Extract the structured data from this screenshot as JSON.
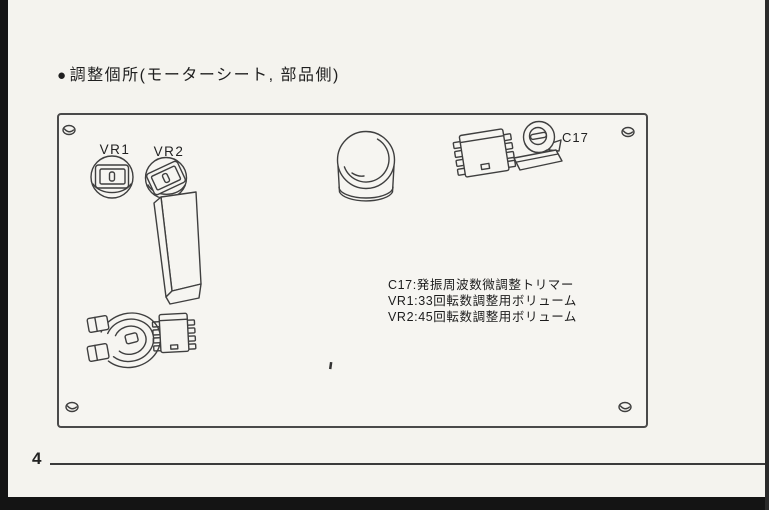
{
  "header": {
    "bullet": "●",
    "title": "調整個所(モーターシート, 部品側)"
  },
  "board": {
    "component_labels": {
      "vr1": "VR1",
      "vr2": "VR2",
      "c17": "C17"
    },
    "notes": [
      "C17:発振周波数微調整トリマー",
      "VR1:33回転数調整用ボリューム",
      "VR2:45回転数調整用ボリューム"
    ]
  },
  "footer": {
    "page_number": "4"
  },
  "colors": {
    "paper": "#f4f3ee",
    "board_fill": "#f6f5f1",
    "line": "#3f3f3f",
    "scan_edge": "#141414"
  }
}
